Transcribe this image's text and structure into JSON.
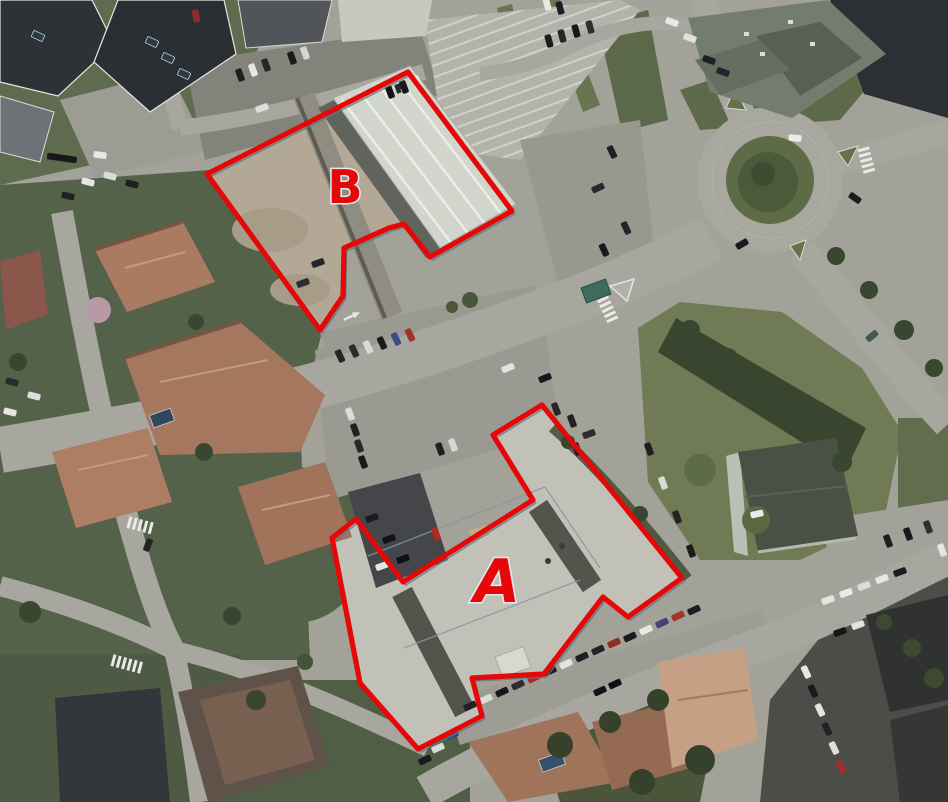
{
  "annotations": {
    "outline_color": "#e60808",
    "parcels": [
      {
        "id": "A",
        "label": "A",
        "points": "542,405 682,578 628,617 603,597 544,674 472,678 482,716 418,749 360,683 332,538 356,519 403,582 533,500 493,435"
      },
      {
        "id": "B",
        "label": "B",
        "points": "408,72 512,211 430,257 404,224 389,228 344,248 343,296 320,330 207,174"
      }
    ]
  },
  "scene": {
    "vehicles": [
      [
        240,
        75,
        70,
        "#1e1e20"
      ],
      [
        253,
        70,
        70,
        "#e7e7e3"
      ],
      [
        266,
        65,
        70,
        "#27272b"
      ],
      [
        292,
        58,
        70,
        "#1b1b1d"
      ],
      [
        305,
        53,
        70,
        "#d6d6d2"
      ],
      [
        390,
        92,
        70,
        "#121214"
      ],
      [
        404,
        87,
        70,
        "#18181a"
      ],
      [
        417,
        82,
        70,
        "#e9e9e5"
      ],
      [
        262,
        108,
        -20,
        "#dededa"
      ],
      [
        549,
        41,
        75,
        "#1c1c1e"
      ],
      [
        562,
        36,
        75,
        "#26262a"
      ],
      [
        576,
        31,
        75,
        "#19191b"
      ],
      [
        590,
        27,
        75,
        "#2f2f33"
      ],
      [
        612,
        152,
        65,
        "#202024"
      ],
      [
        598,
        188,
        -25,
        "#2a2a2e"
      ],
      [
        626,
        228,
        65,
        "#232327"
      ],
      [
        604,
        250,
        65,
        "#17181c"
      ],
      [
        88,
        182,
        15,
        "#e5e5e1"
      ],
      [
        110,
        176,
        15,
        "#dadad6"
      ],
      [
        132,
        184,
        15,
        "#1f1f23"
      ],
      [
        68,
        196,
        15,
        "#222226"
      ],
      [
        62,
        158,
        8,
        "#18181a",
        30
      ],
      [
        100,
        155,
        8,
        "#e8e8e4"
      ],
      [
        196,
        16,
        80,
        "#8d2f26"
      ],
      [
        560,
        8,
        75,
        "#1d1e22"
      ],
      [
        547,
        4,
        75,
        "#e7e7e3"
      ],
      [
        340,
        356,
        65,
        "#242428"
      ],
      [
        354,
        351,
        65,
        "#2b2b2f"
      ],
      [
        368,
        347,
        65,
        "#d9d9d5"
      ],
      [
        382,
        343,
        65,
        "#1a1c1f"
      ],
      [
        396,
        339,
        65,
        "#3c4c86"
      ],
      [
        410,
        335,
        65,
        "#a33327"
      ],
      [
        508,
        368,
        -22,
        "#e2e2de"
      ],
      [
        545,
        378,
        -22,
        "#18191d"
      ],
      [
        303,
        283,
        -20,
        "#2d2e32"
      ],
      [
        318,
        263,
        -20,
        "#242529"
      ],
      [
        350,
        414,
        70,
        "#dcdcd8"
      ],
      [
        355,
        430,
        70,
        "#202024"
      ],
      [
        359,
        446,
        70,
        "#28282c"
      ],
      [
        363,
        462,
        70,
        "#17171b"
      ],
      [
        440,
        449,
        70,
        "#1f1f21"
      ],
      [
        453,
        445,
        70,
        "#d6d6d2"
      ],
      [
        372,
        518,
        -20,
        "#1c1d21"
      ],
      [
        389,
        539,
        -20,
        "#121316"
      ],
      [
        403,
        559,
        -20,
        "#0f1013"
      ],
      [
        382,
        566,
        -20,
        "#e5e5e1"
      ],
      [
        436,
        534,
        70,
        "#b1291f"
      ],
      [
        572,
        421,
        70,
        "#212125"
      ],
      [
        589,
        434,
        -20,
        "#2c2c30"
      ],
      [
        577,
        449,
        70,
        "#19191d"
      ],
      [
        556,
        409,
        70,
        "#26262a"
      ],
      [
        649,
        449,
        70,
        "#1e1e20"
      ],
      [
        663,
        483,
        70,
        "#d9d9d5"
      ],
      [
        677,
        517,
        70,
        "#232327"
      ],
      [
        691,
        551,
        70,
        "#1b1b1d"
      ],
      [
        470,
        706,
        -25,
        "#202125"
      ],
      [
        486,
        699,
        -25,
        "#dadad6"
      ],
      [
        502,
        692,
        -25,
        "#16171b"
      ],
      [
        518,
        685,
        -25,
        "#2d2e32"
      ],
      [
        534,
        678,
        -25,
        "#b12a20"
      ],
      [
        550,
        671,
        -25,
        "#18191d"
      ],
      [
        566,
        664,
        -25,
        "#e4e4e0"
      ],
      [
        582,
        657,
        -25,
        "#1e1f23"
      ],
      [
        598,
        650,
        -25,
        "#242529"
      ],
      [
        614,
        643,
        -25,
        "#8b2f25"
      ],
      [
        630,
        637,
        -25,
        "#1b1c20"
      ],
      [
        646,
        630,
        -25,
        "#e7e7e3"
      ],
      [
        662,
        623,
        -25,
        "#483f77"
      ],
      [
        678,
        616,
        -25,
        "#a43328"
      ],
      [
        694,
        610,
        -25,
        "#1d1e22"
      ],
      [
        600,
        691,
        -25,
        "#121317"
      ],
      [
        615,
        684,
        -25,
        "#0f1014"
      ],
      [
        452,
        735,
        -25,
        "#34428b"
      ],
      [
        438,
        748,
        -25,
        "#dadad6"
      ],
      [
        425,
        760,
        -25,
        "#18191c"
      ],
      [
        828,
        600,
        -20,
        "#e3e3df"
      ],
      [
        846,
        593,
        -20,
        "#e9e9e5"
      ],
      [
        864,
        586,
        -20,
        "#dbdbd7"
      ],
      [
        882,
        579,
        -20,
        "#e6e6e2"
      ],
      [
        900,
        572,
        -20,
        "#1c1d21"
      ],
      [
        840,
        632,
        -20,
        "#16171b"
      ],
      [
        858,
        625,
        -20,
        "#e2e2de"
      ],
      [
        888,
        541,
        70,
        "#1e1f23"
      ],
      [
        908,
        534,
        70,
        "#18191d"
      ],
      [
        928,
        527,
        70,
        "#303136"
      ],
      [
        942,
        550,
        70,
        "#e5e5e1"
      ],
      [
        872,
        336,
        -40,
        "#3e5a50"
      ],
      [
        795,
        138,
        5,
        "#ebebe7"
      ],
      [
        855,
        198,
        35,
        "#1c1d21"
      ],
      [
        742,
        244,
        -30,
        "#18191d"
      ],
      [
        672,
        22,
        20,
        "#e9e9e5"
      ],
      [
        690,
        38,
        20,
        "#e0e0dc"
      ],
      [
        709,
        60,
        20,
        "#1f2024"
      ],
      [
        723,
        72,
        20,
        "#25262a"
      ],
      [
        12,
        382,
        15,
        "#2b2c30"
      ],
      [
        34,
        396,
        15,
        "#ddddd9"
      ],
      [
        10,
        412,
        15,
        "#e4e4e0"
      ],
      [
        148,
        545,
        -70,
        "#212226"
      ],
      [
        806,
        672,
        65,
        "#e7e7e3"
      ],
      [
        813,
        691,
        65,
        "#1a1b1f"
      ],
      [
        820,
        710,
        65,
        "#e3e3df"
      ],
      [
        827,
        729,
        65,
        "#212226"
      ],
      [
        834,
        748,
        65,
        "#dfdfdb"
      ],
      [
        841,
        767,
        65,
        "#a03027"
      ],
      [
        757,
        514,
        -12,
        "#e9e9e7"
      ]
    ],
    "crosswalks": [
      [
        600,
        293,
        65,
        6
      ],
      [
        128,
        522,
        15,
        5
      ],
      [
        112,
        660,
        15,
        6
      ],
      [
        863,
        148,
        75,
        5
      ],
      [
        722,
        75,
        10,
        4
      ]
    ]
  }
}
